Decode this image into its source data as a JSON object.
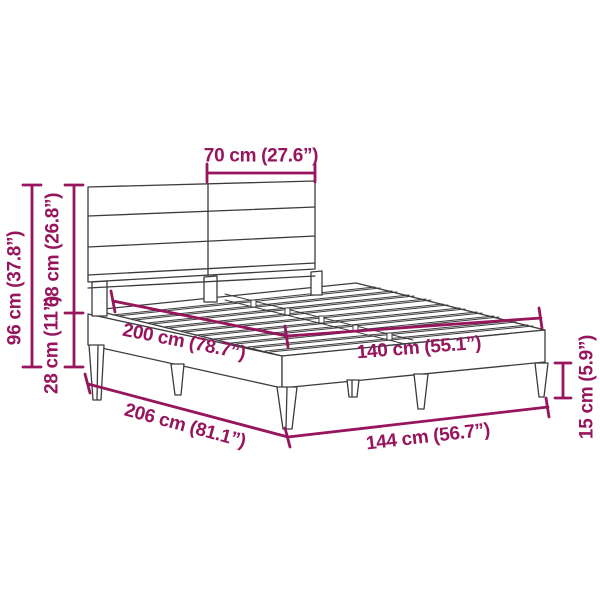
{
  "colors": {
    "dimension_accent": "#97155C",
    "drawing_line": "#3C3C3C",
    "background": "#FFFFFF"
  },
  "diagram": {
    "subject": "Bed frame with headboard — technical dimension drawing",
    "dimensions": [
      {
        "id": "headboard-panel-width",
        "label": "70 cm (27.6”)"
      },
      {
        "id": "overall-height",
        "label": "96 cm (37.8”)"
      },
      {
        "id": "headboard-height",
        "label": "68 cm (26.8”)"
      },
      {
        "id": "frame-height",
        "label": "28 cm (11”)"
      },
      {
        "id": "bed-length",
        "label": "200 cm (78.7”)"
      },
      {
        "id": "bed-width",
        "label": "140 cm (55.1”)"
      },
      {
        "id": "overall-length",
        "label": "206 cm (81.1”)"
      },
      {
        "id": "overall-width",
        "label": "144 cm (56.7”)"
      },
      {
        "id": "leg-height",
        "label": "15 cm (5.9”)"
      }
    ]
  }
}
